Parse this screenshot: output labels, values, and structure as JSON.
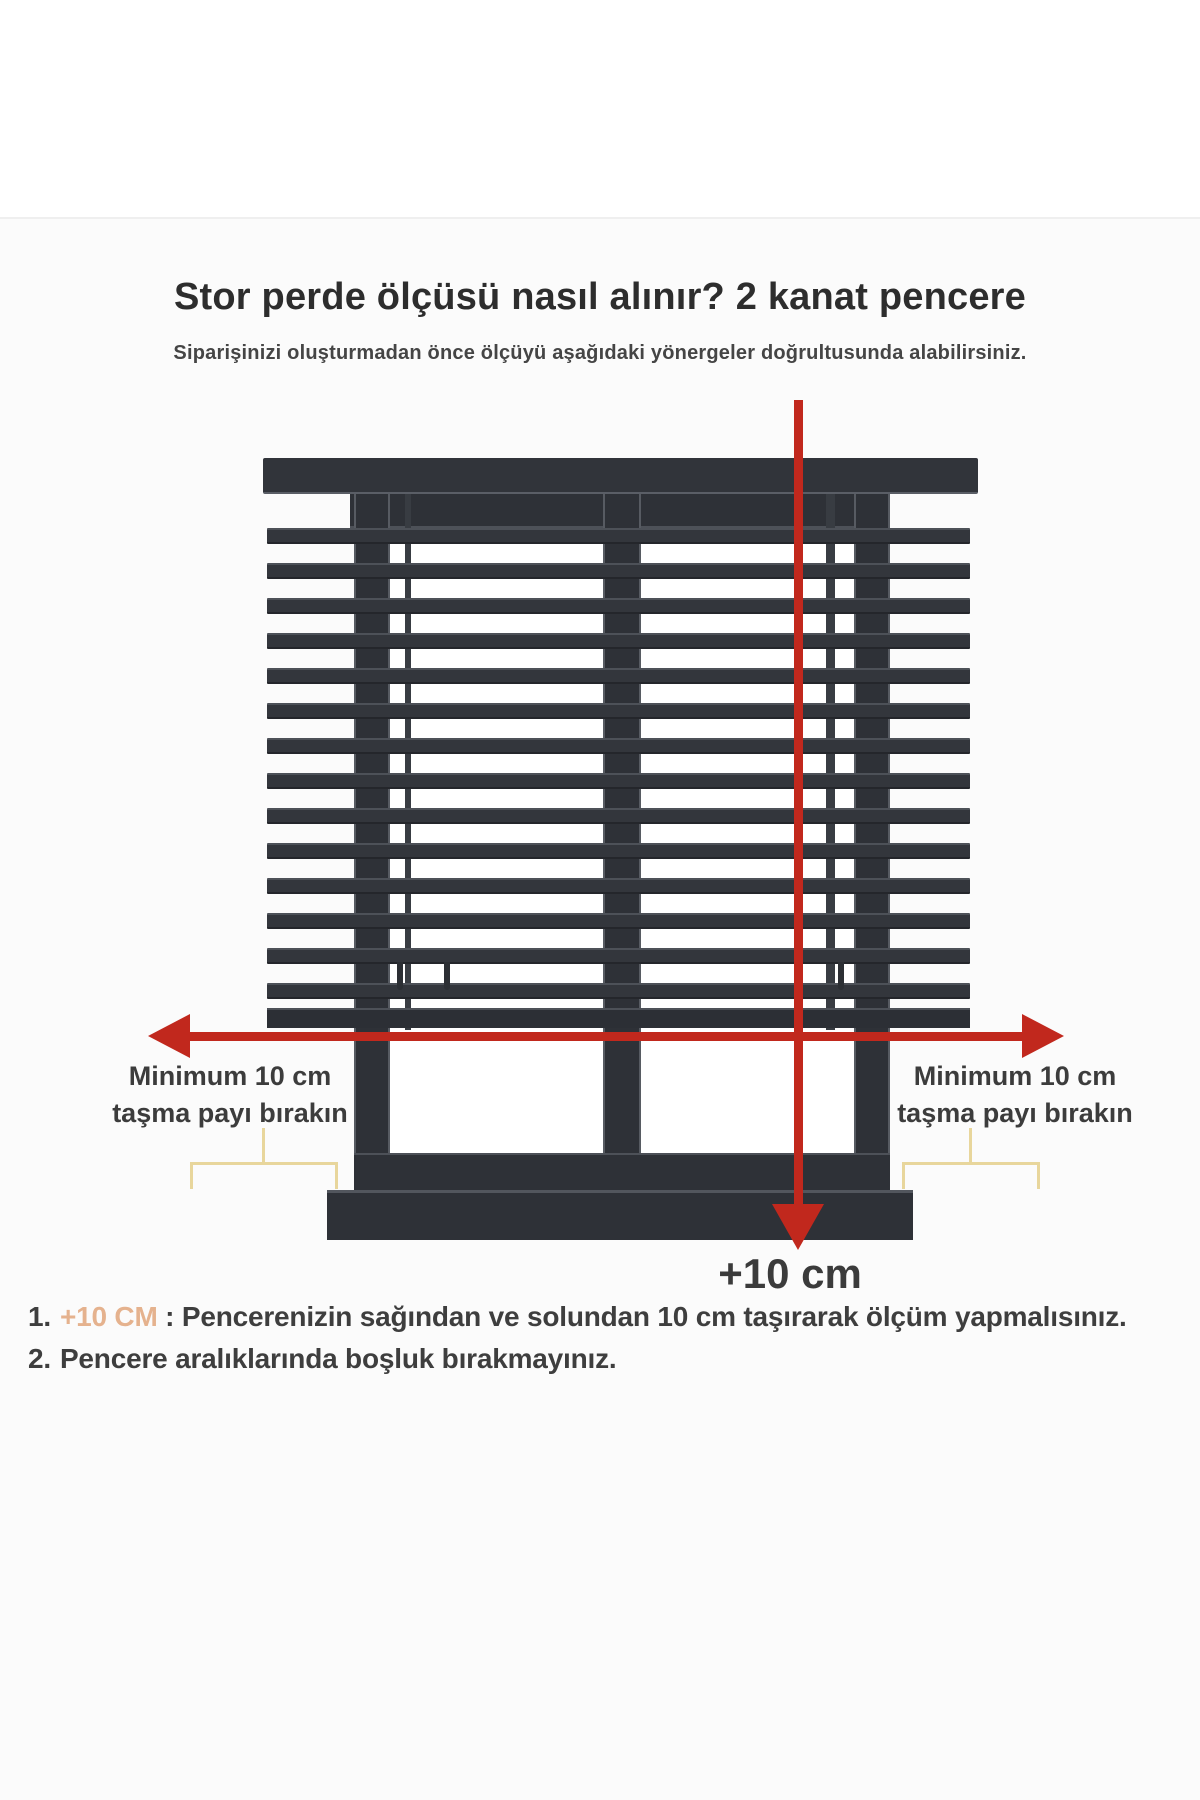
{
  "page": {
    "title": "Stor perde ölçüsü nasıl alınır? 2 kanat pencere",
    "subtitle": "Siparişinizi oluşturmadan önce ölçüyü aşağıdaki yönergeler doğrultusunda alabilirsiniz."
  },
  "diagram": {
    "type": "window-blind-measurement",
    "window_wings": 2,
    "blind": {
      "slat_count": 14
    },
    "labels": {
      "left": {
        "line1": "Minimum 10 cm",
        "line2": "taşma payı bırakın"
      },
      "right": {
        "line1": "Minimum 10 cm",
        "line2": "taşma payı bırakın"
      },
      "bottom": "+10 cm"
    },
    "colors": {
      "arrow": "#c1281d",
      "blind": "#31343a",
      "window": "#2e3137",
      "bracket": "#e8d69c"
    }
  },
  "instructions": {
    "highlight_color": "#e5b28e",
    "items": [
      {
        "number": "1.",
        "highlight": "+10 CM",
        "text": " : Pencerenizin sağından ve solundan 10 cm taşırarak ölçüm yapmalısınız."
      },
      {
        "number": "2.",
        "highlight": "",
        "text": "Pencere aralıklarında boşluk bırakmayınız."
      }
    ]
  }
}
